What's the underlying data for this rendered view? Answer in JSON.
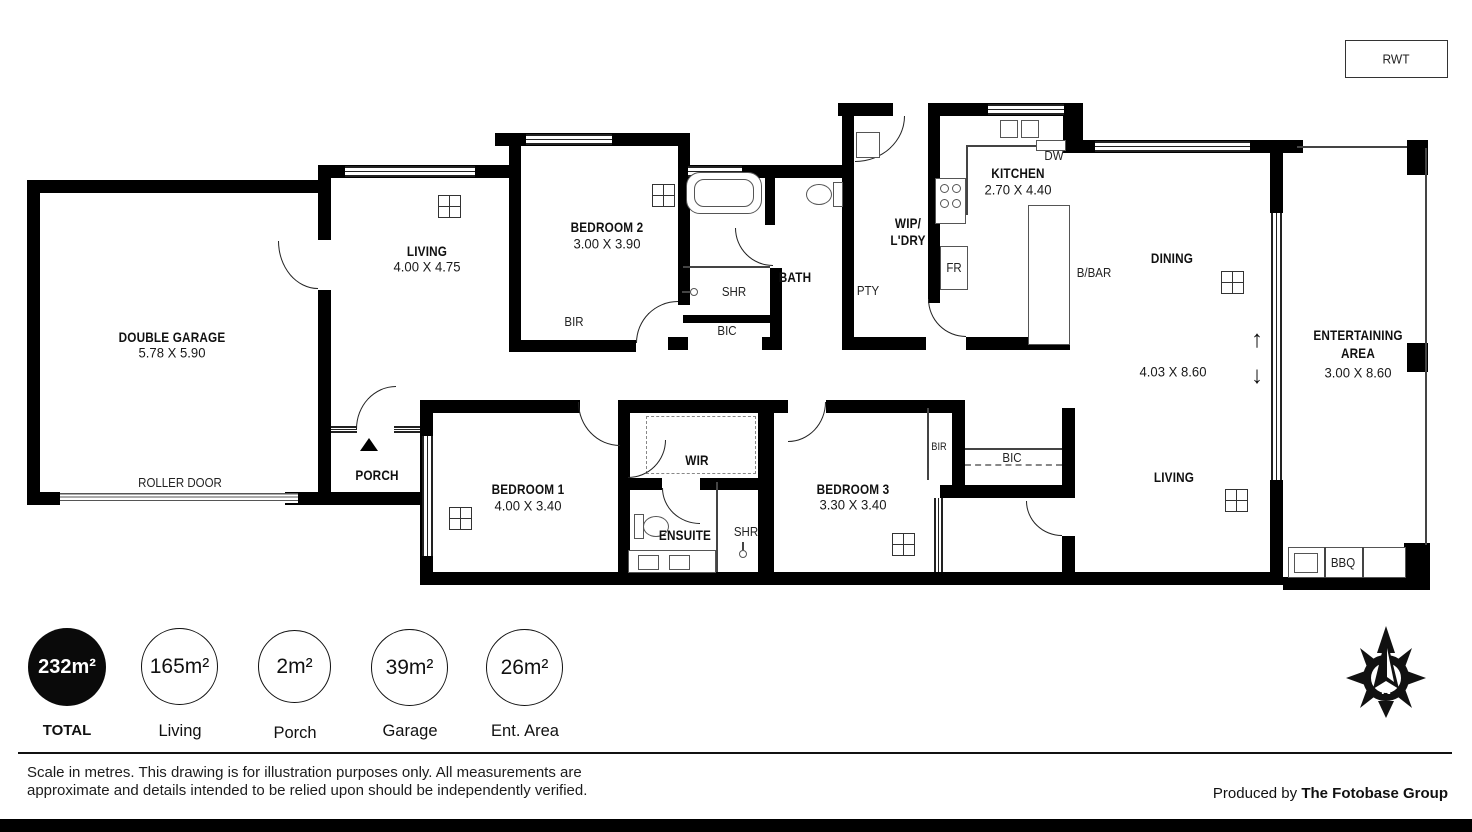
{
  "rwt_label": "RWT",
  "colors": {
    "wall": "#000000",
    "background": "#ffffff"
  },
  "rooms": {
    "garage": {
      "name": "DOUBLE GARAGE",
      "dims": "5.78 X 5.90"
    },
    "living_top": {
      "name": "LIVING",
      "dims": "4.00 X 4.75"
    },
    "bedroom2": {
      "name": "BEDROOM 2",
      "dims": "3.00 X 3.90"
    },
    "bath": {
      "name": "BATH"
    },
    "wip": {
      "line1": "WIP/",
      "line2": "L'DRY"
    },
    "kitchen": {
      "name": "KITCHEN",
      "dims": "2.70 X 4.40"
    },
    "dining": {
      "name": "DINING",
      "dims": "4.03 X 8.60"
    },
    "entertaining": {
      "name": "ENTERTAINING AREA",
      "dims": "3.00 X 8.60"
    },
    "living_bottom": {
      "name": "LIVING"
    },
    "porch": {
      "name": "PORCH"
    },
    "bedroom1": {
      "name": "BEDROOM 1",
      "dims": "4.00 X 3.40"
    },
    "wir": {
      "name": "WIR"
    },
    "ensuite": {
      "name": "ENSUITE"
    },
    "bedroom3": {
      "name": "BEDROOM 3",
      "dims": "3.30 X 3.40"
    }
  },
  "fixtures": {
    "roller_door": "ROLLER DOOR",
    "bir": "BIR",
    "bic": "BIC",
    "shr": "SHR",
    "pty": "PTY",
    "fr": "FR",
    "dw": "DW",
    "bbar": "B/BAR",
    "bbq": "BBQ"
  },
  "slider": {
    "up": "↑",
    "down": "↓"
  },
  "areas": [
    {
      "value": "232m²",
      "label": "TOTAL"
    },
    {
      "value": "165m²",
      "label": "Living"
    },
    {
      "value": "2m²",
      "label": "Porch"
    },
    {
      "value": "39m²",
      "label": "Garage"
    },
    {
      "value": "26m²",
      "label": "Ent. Area"
    }
  ],
  "footer": {
    "disclaimer1": "Scale in metres. This drawing is for illustration purposes only. All measurements are",
    "disclaimer2": "approximate and details intended to be relied upon should be independently verified.",
    "credit_prefix": "Produced by",
    "credit_brand": "The Fotobase Group"
  },
  "compass_letter": "N"
}
